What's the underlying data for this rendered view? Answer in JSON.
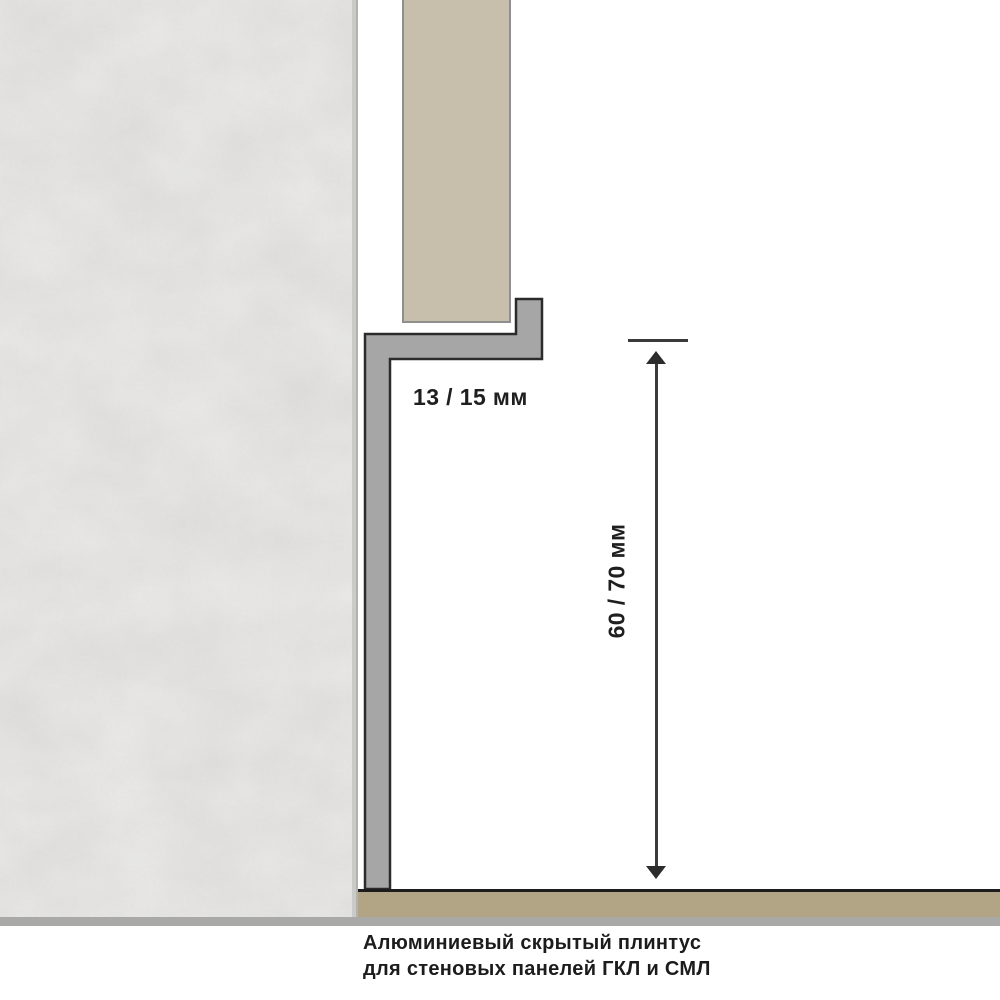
{
  "diagram": {
    "title": "hidden aluminium plinth section drawing",
    "dimensions": {
      "depth_label": "13 / 15 мм",
      "height_label": "60 / 70 мм"
    },
    "caption": {
      "line1": "Алюминиевый скрытый плинтус",
      "line2": "для стеновых панелей ГКЛ и СМЛ"
    },
    "elements": {
      "wall": "concrete-wall",
      "panel": "wall-panel",
      "profile": "aluminium-plinth-profile",
      "floor": "floor-strip",
      "base": "base-strip"
    },
    "colors": {
      "background": "#ffffff",
      "wall": "#dfdedc",
      "wall_edge": "#c3c3c1",
      "panel": "#c8bfab",
      "panel_border": "#8f8f8d",
      "profile_fill": "#a6a6a6",
      "profile_outline": "#2b2b2b",
      "floor": "#b2a586",
      "floor_line": "#1c1c1c",
      "base_strip": "#a9a9a7",
      "dimension_line": "#3a3a3a",
      "text": "#1f1f1f"
    }
  }
}
